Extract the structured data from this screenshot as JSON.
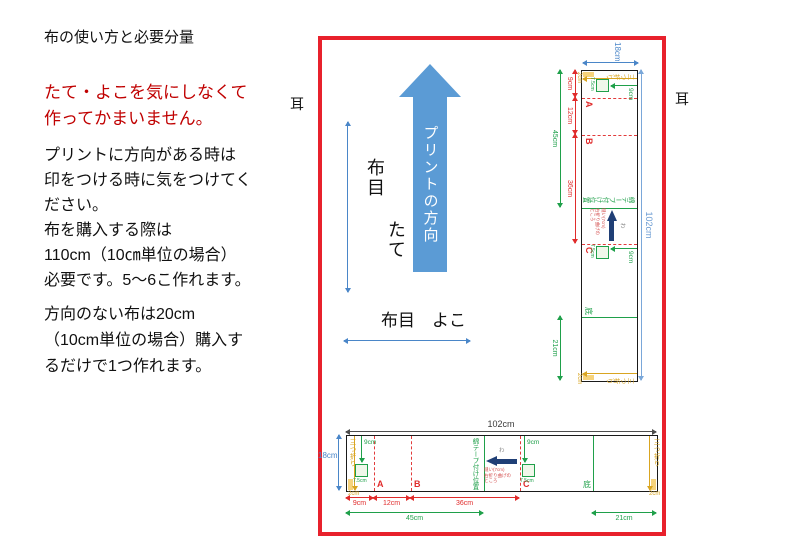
{
  "left_panel": {
    "title": "布の使い方と必要分量",
    "red_note": [
      "たて・よこを気にしなくて",
      "作ってかまいません。"
    ],
    "para1": [
      "プリントに方向がある時は",
      "印をつける時に気をつけてく",
      "ださい。",
      "布を購入する際は",
      "110cm（10㎝単位の場合）",
      "必要です。5～6こ作れます。"
    ],
    "para2": [
      "方向のない布は20cm",
      "（10cm単位の場合）購入す",
      "るだけで1つ作れます。"
    ]
  },
  "selvage": {
    "left": "耳",
    "right": "耳"
  },
  "diagram": {
    "print_direction": "プリントの方向",
    "grain_v_1": "布目",
    "grain_v_2": "たて",
    "grain_h": "布目　よこ"
  },
  "strip": {
    "width_label": "102cm",
    "height_label": "18cm",
    "seg_9": "9cm",
    "seg_12": "12cm",
    "seg_36": "36cm",
    "seg_45": "45cm",
    "seg_21": "21cm",
    "fold_left": "三つ折り",
    "fold_right": "三つ折り",
    "allowance_left": "2cm",
    "allowance_right": "2cm",
    "mark_a": "A",
    "mark_b": "B",
    "mark_c": "C",
    "tape_label": "綿テープ付け位置",
    "bottom_label": "底",
    "pocket_depth_1": "9cm",
    "pocket_size_1": "7.5cm",
    "pocket_depth_2": "9cm",
    "pocket_size_2": "7.5cm",
    "fold_mark": "わ",
    "note": [
      "縫い(7cm)",
      "右折り曲げの",
      "ところ"
    ]
  },
  "colors": {
    "frame_red": "#e8212c",
    "arrow_blue": "#5b9bd5",
    "dim_blue": "#4a86c8",
    "green": "#1fa04a",
    "yellow": "#d9a521",
    "mark_red": "#e02b2b",
    "navy": "#203f76",
    "text_red": "#c00000"
  }
}
